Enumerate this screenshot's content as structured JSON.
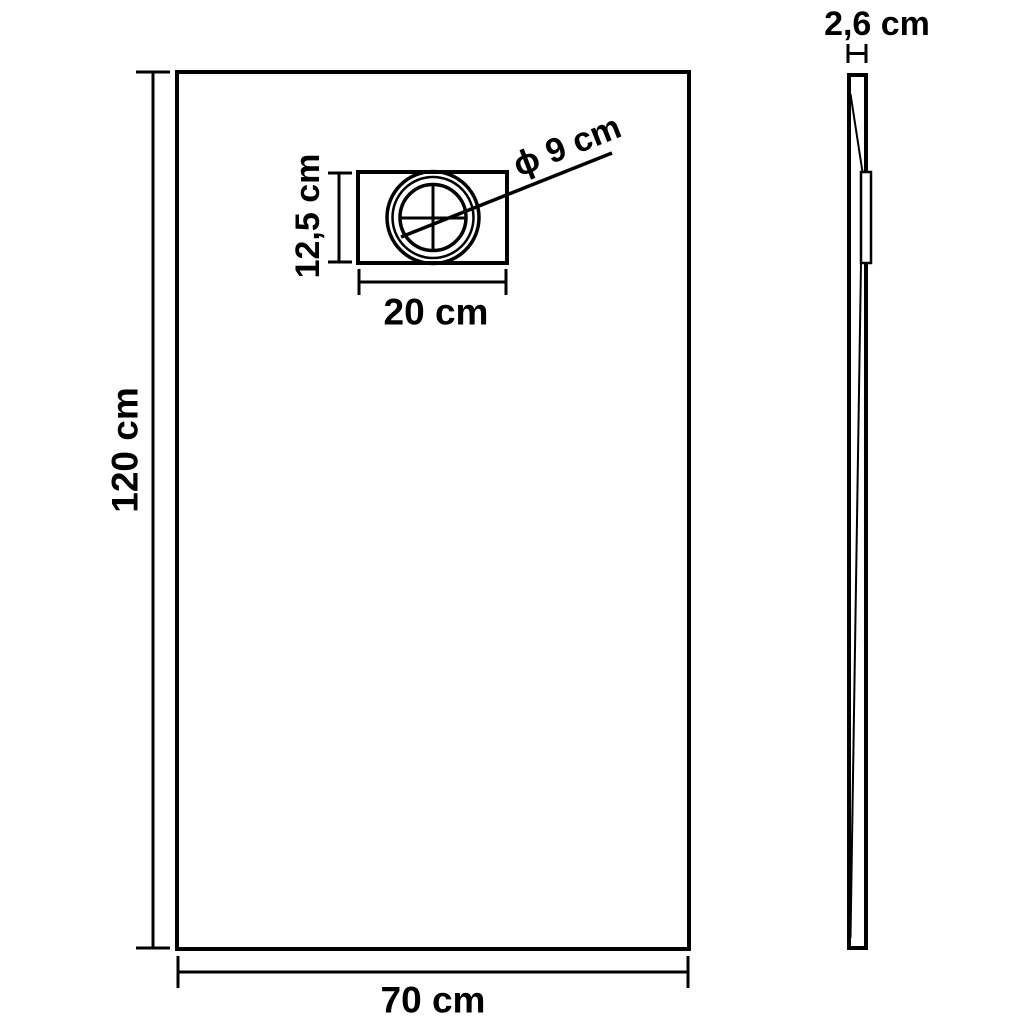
{
  "diagram": {
    "type": "technical-dimension-drawing",
    "colors": {
      "line": "#000000",
      "background": "#ffffff",
      "centerline": "#b3b3b3"
    },
    "front_view": {
      "height_label": "120 cm",
      "width_label": "70 cm",
      "drain_box": {
        "height_label": "12,5 cm",
        "width_label": "20 cm",
        "drain_diameter_label": "ϕ 9 cm"
      }
    },
    "side_view": {
      "thickness_label": "2,6 cm"
    },
    "dimensions_cm": {
      "tray_height": 120,
      "tray_width": 70,
      "tray_thickness": 2.6,
      "drain_box_height": 12.5,
      "drain_box_width": 20,
      "drain_diameter": 9
    }
  }
}
